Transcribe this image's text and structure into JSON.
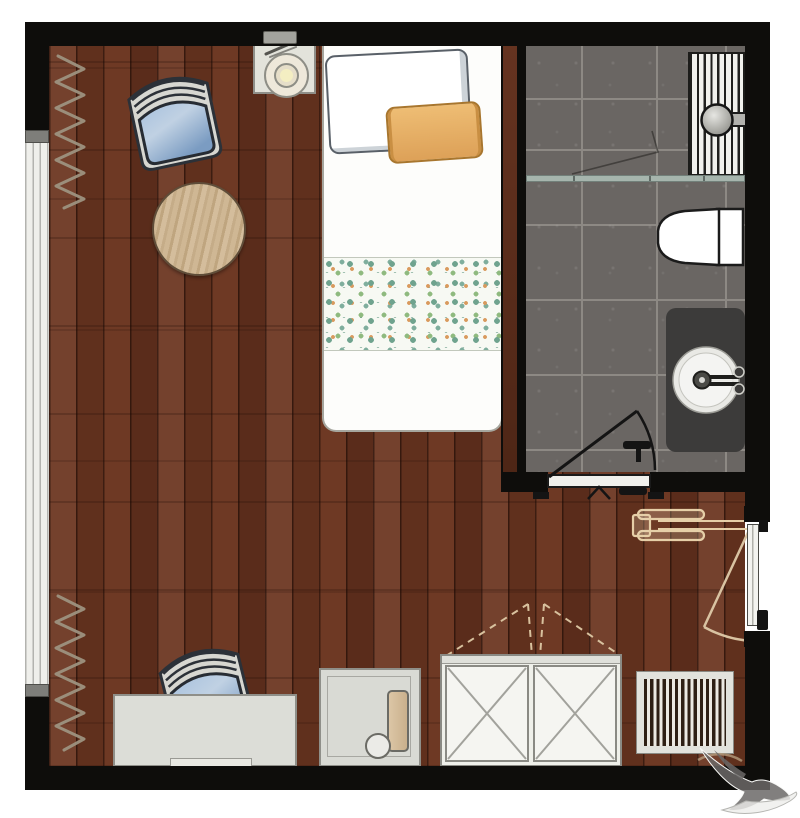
{
  "meta": {
    "kind": "architectural-floor-plan",
    "title": "Accessible bedroom with en-suite bathroom",
    "visible_text": "none"
  },
  "theme": {
    "colors": {
      "wall": "#0e0d0b",
      "floor": "#6b3520",
      "tile": "#6a6663",
      "glass": "#a6b5ad",
      "furnlight": "#dcddd7",
      "furnborder": "#8f8f89",
      "vanity": "#3c3b3a",
      "chairblue": "#7e9cc2",
      "pilloworange": "#e0a65c",
      "tablewood": "#ccb491",
      "curtain": "#9d9280",
      "swingtan": "#d9c3a2",
      "watermark": "#6b6967"
    }
  },
  "rooms": [
    {
      "id": "bedroom",
      "floor": "dark-wood-planks"
    },
    {
      "id": "bathroom",
      "floor": "grey-stone-tile",
      "position": "top-right"
    }
  ],
  "furniture": [
    {
      "id": "bed-single",
      "area": "top-center",
      "items": [
        "white-pillow",
        "orange-pillow",
        "floral-blanket"
      ]
    },
    {
      "id": "nightstand-with-lamp",
      "area": "top-left-of-bed"
    },
    {
      "id": "chair-blue-1",
      "area": "upper-left"
    },
    {
      "id": "round-side-table",
      "area": "upper-left"
    },
    {
      "id": "chair-blue-2",
      "area": "bottom-left"
    },
    {
      "id": "desk",
      "area": "bottom-left"
    },
    {
      "id": "side-cabinet",
      "area": "bottom-center"
    },
    {
      "id": "wardrobe-double-x-doors",
      "area": "bottom-center"
    },
    {
      "id": "floor-vent-grille",
      "area": "bottom-right"
    }
  ],
  "fixtures": [
    {
      "id": "shower-with-drain-grille",
      "area": "bathroom-top"
    },
    {
      "id": "shower-glass-partition",
      "area": "bathroom-middle"
    },
    {
      "id": "toilet",
      "area": "bathroom-right"
    },
    {
      "id": "vanity-with-round-sink",
      "area": "bathroom-bottom-right"
    },
    {
      "id": "bathroom-door-swing",
      "area": "bathroom-bottom"
    },
    {
      "id": "entry-door-swing",
      "area": "right-wall"
    }
  ],
  "symbols": [
    {
      "id": "curtain-zigzag-top",
      "meaning": "curtain at window"
    },
    {
      "id": "curtain-zigzag-bottom",
      "meaning": "curtain at window"
    },
    {
      "id": "wheelchair-clearance",
      "meaning": "accessible approach at entry door"
    },
    {
      "id": "wardrobe-door-swing-dashed",
      "meaning": "wardrobe doors opening direction"
    }
  ],
  "watermark": {
    "icon": "bird-silhouette",
    "position": "bottom-right-corner"
  }
}
